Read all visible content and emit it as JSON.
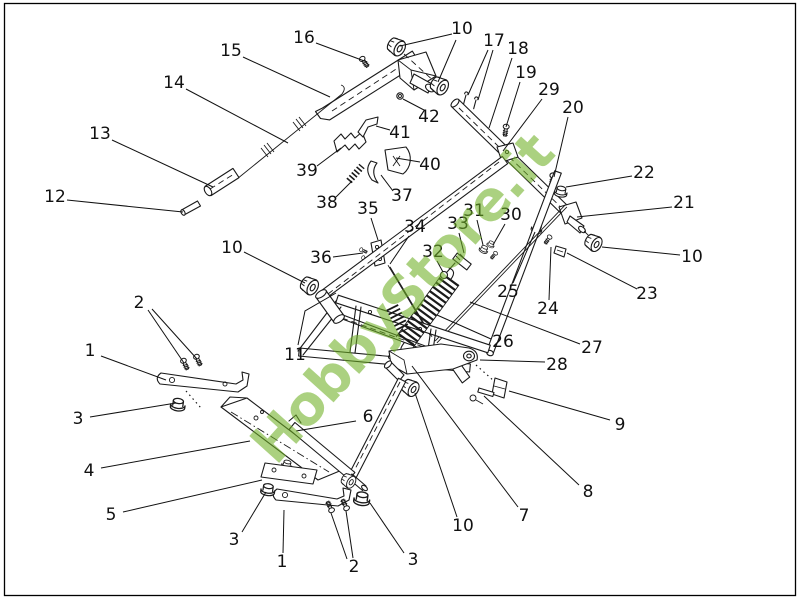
{
  "page": {
    "background": "#ffffff",
    "border_color": "#000000"
  },
  "watermark": {
    "text": "HobbyStore.it",
    "color": "rgba(110,175,37,0.58)",
    "rotation_deg": -48,
    "font_size": 55,
    "cx": 402,
    "cy": 298
  },
  "diagram": {
    "kind": "exploded-parts-diagram",
    "label_font_size": 17,
    "label_color": "#111111",
    "line_color": "#1a1a1a",
    "labels": [
      {
        "text": "16",
        "x": 304,
        "y": 38,
        "leaders": [
          [
            [
              316,
              43
            ],
            [
              367,
              62
            ]
          ]
        ]
      },
      {
        "text": "15",
        "x": 231,
        "y": 51,
        "leaders": [
          [
            [
              243,
              57
            ],
            [
              330,
              97
            ]
          ]
        ]
      },
      {
        "text": "10",
        "x": 462,
        "y": 29,
        "leaders": [
          [
            [
              452,
              34
            ],
            [
              400,
              46
            ]
          ],
          [
            [
              456,
              40
            ],
            [
              438,
              82
            ]
          ]
        ]
      },
      {
        "text": "17",
        "x": 494,
        "y": 41,
        "leaders": [
          [
            [
              488,
              50
            ],
            [
              468,
              95
            ]
          ],
          [
            [
              493,
              50
            ],
            [
              478,
              100
            ]
          ]
        ]
      },
      {
        "text": "18",
        "x": 518,
        "y": 49,
        "leaders": [
          [
            [
              512,
              58
            ],
            [
              489,
              128
            ]
          ]
        ]
      },
      {
        "text": "19",
        "x": 526,
        "y": 73,
        "leaders": [
          [
            [
              520,
              82
            ],
            [
              506,
              127
            ]
          ]
        ]
      },
      {
        "text": "29",
        "x": 549,
        "y": 90,
        "leaders": [
          [
            [
              542,
              99
            ],
            [
              503,
              151
            ]
          ]
        ]
      },
      {
        "text": "20",
        "x": 573,
        "y": 108,
        "leaders": [
          [
            [
              568,
              117
            ],
            [
              554,
              177
            ]
          ]
        ]
      },
      {
        "text": "14",
        "x": 174,
        "y": 83,
        "leaders": [
          [
            [
              186,
              89
            ],
            [
              288,
              143
            ]
          ]
        ]
      },
      {
        "text": "13",
        "x": 100,
        "y": 134,
        "leaders": [
          [
            [
              112,
              140
            ],
            [
              213,
              187
            ]
          ]
        ]
      },
      {
        "text": "12",
        "x": 55,
        "y": 197,
        "leaders": [
          [
            [
              67,
              200
            ],
            [
              183,
              212
            ]
          ]
        ]
      },
      {
        "text": "42",
        "x": 429,
        "y": 117,
        "leaders": [
          [
            [
              424,
              110
            ],
            [
              403,
              99
            ]
          ]
        ]
      },
      {
        "text": "41",
        "x": 400,
        "y": 133,
        "leaders": [
          [
            [
              390,
              130
            ],
            [
              376,
              126
            ]
          ]
        ]
      },
      {
        "text": "39",
        "x": 307,
        "y": 171,
        "leaders": [
          [
            [
              317,
              166
            ],
            [
              341,
              148
            ]
          ]
        ]
      },
      {
        "text": "40",
        "x": 430,
        "y": 165,
        "leaders": [
          [
            [
              420,
              162
            ],
            [
              396,
              158
            ]
          ]
        ]
      },
      {
        "text": "38",
        "x": 327,
        "y": 203,
        "leaders": [
          [
            [
              336,
              197
            ],
            [
              352,
              181
            ]
          ]
        ]
      },
      {
        "text": "37",
        "x": 402,
        "y": 196,
        "leaders": [
          [
            [
              393,
              191
            ],
            [
              381,
              175
            ]
          ]
        ]
      },
      {
        "text": "35",
        "x": 368,
        "y": 209,
        "leaders": [
          [
            [
              371,
              218
            ],
            [
              378,
              240
            ]
          ]
        ]
      },
      {
        "text": "36",
        "x": 321,
        "y": 258,
        "leaders": [
          [
            [
              333,
              257
            ],
            [
              363,
              253
            ]
          ]
        ]
      },
      {
        "text": "34",
        "x": 415,
        "y": 227,
        "leaders": [
          [
            [
              409,
              236
            ],
            [
              390,
              264
            ]
          ]
        ]
      },
      {
        "text": "33",
        "x": 458,
        "y": 224,
        "leaders": [
          [
            [
              459,
              233
            ],
            [
              464,
              253
            ]
          ]
        ]
      },
      {
        "text": "31",
        "x": 474,
        "y": 211,
        "leaders": [
          [
            [
              477,
              220
            ],
            [
              483,
              245
            ]
          ]
        ]
      },
      {
        "text": "30",
        "x": 511,
        "y": 215,
        "leaders": [
          [
            [
              505,
              224
            ],
            [
              493,
              245
            ]
          ]
        ]
      },
      {
        "text": "22",
        "x": 644,
        "y": 173,
        "leaders": [
          [
            [
              632,
              176
            ],
            [
              566,
              187
            ]
          ]
        ]
      },
      {
        "text": "21",
        "x": 684,
        "y": 203,
        "leaders": [
          [
            [
              672,
              207
            ],
            [
              577,
              217
            ]
          ]
        ]
      },
      {
        "text": "10",
        "x": 692,
        "y": 257,
        "leaders": [
          [
            [
              680,
              255
            ],
            [
              602,
              247
            ]
          ]
        ]
      },
      {
        "text": "23",
        "x": 647,
        "y": 294,
        "leaders": [
          [
            [
              637,
              289
            ],
            [
              567,
              253
            ]
          ]
        ]
      },
      {
        "text": "24",
        "x": 548,
        "y": 309,
        "leaders": [
          [
            [
              549,
              300
            ],
            [
              551,
              247
            ]
          ]
        ]
      },
      {
        "text": "25",
        "x": 508,
        "y": 292,
        "leaders": [
          [
            [
              513,
              283
            ],
            [
              535,
              232
            ]
          ]
        ]
      },
      {
        "text": "32",
        "x": 433,
        "y": 252,
        "leaders": [
          [
            [
              437,
              261
            ],
            [
              443,
              272
            ]
          ]
        ]
      },
      {
        "text": "26",
        "x": 503,
        "y": 342,
        "leaders": [
          [
            [
              491,
              339
            ],
            [
              437,
              315
            ]
          ]
        ]
      },
      {
        "text": "27",
        "x": 592,
        "y": 348,
        "leaders": [
          [
            [
              580,
              344
            ],
            [
              470,
              302
            ]
          ]
        ]
      },
      {
        "text": "28",
        "x": 557,
        "y": 365,
        "leaders": [
          [
            [
              545,
              362
            ],
            [
              480,
              360
            ]
          ]
        ]
      },
      {
        "text": "9",
        "x": 620,
        "y": 425,
        "leaders": [
          [
            [
              610,
              420
            ],
            [
              509,
              391
            ]
          ]
        ]
      },
      {
        "text": "8",
        "x": 588,
        "y": 492,
        "leaders": [
          [
            [
              579,
              485
            ],
            [
              484,
              396
            ]
          ]
        ]
      },
      {
        "text": "7",
        "x": 524,
        "y": 516,
        "leaders": [
          [
            [
              518,
              507
            ],
            [
              412,
              366
            ]
          ]
        ]
      },
      {
        "text": "10",
        "x": 463,
        "y": 526,
        "leaders": [
          [
            [
              457,
              517
            ],
            [
              415,
              393
            ]
          ]
        ]
      },
      {
        "text": "3",
        "x": 413,
        "y": 560,
        "leaders": [
          [
            [
              404,
              553
            ],
            [
              370,
              503
            ]
          ]
        ]
      },
      {
        "text": "2",
        "x": 354,
        "y": 567,
        "leaders": [
          [
            [
              347,
              559
            ],
            [
              331,
              513
            ]
          ],
          [
            [
              353,
              558
            ],
            [
              346,
              511
            ]
          ]
        ]
      },
      {
        "text": "1",
        "x": 282,
        "y": 562,
        "leaders": [
          [
            [
              283,
              553
            ],
            [
              284,
              510
            ]
          ]
        ]
      },
      {
        "text": "3",
        "x": 234,
        "y": 540,
        "leaders": [
          [
            [
              242,
              532
            ],
            [
              266,
              492
            ]
          ]
        ]
      },
      {
        "text": "5",
        "x": 111,
        "y": 515,
        "leaders": [
          [
            [
              123,
              512
            ],
            [
              262,
              480
            ]
          ]
        ]
      },
      {
        "text": "4",
        "x": 89,
        "y": 471,
        "leaders": [
          [
            [
              101,
              468
            ],
            [
              250,
              441
            ]
          ]
        ]
      },
      {
        "text": "6",
        "x": 368,
        "y": 417,
        "leaders": [
          [
            [
              356,
              421
            ],
            [
              296,
              431
            ]
          ]
        ]
      },
      {
        "text": "3",
        "x": 78,
        "y": 419,
        "leaders": [
          [
            [
              90,
              417
            ],
            [
              176,
              403
            ]
          ]
        ]
      },
      {
        "text": "1",
        "x": 90,
        "y": 351,
        "leaders": [
          [
            [
              101,
              356
            ],
            [
              166,
              380
            ]
          ]
        ]
      },
      {
        "text": "2",
        "x": 139,
        "y": 303,
        "leaders": [
          [
            [
              148,
              310
            ],
            [
              184,
              363
            ]
          ],
          [
            [
              152,
              309
            ],
            [
              197,
              359
            ]
          ]
        ]
      },
      {
        "text": "11",
        "x": 295,
        "y": 355,
        "leaders": [
          [
            [
              298,
              345
            ],
            [
              305,
              311
            ],
            [
              336,
              293
            ]
          ]
        ]
      },
      {
        "text": "10",
        "x": 232,
        "y": 248,
        "leaders": [
          [
            [
              244,
              252
            ],
            [
              305,
              283
            ]
          ]
        ]
      }
    ]
  }
}
